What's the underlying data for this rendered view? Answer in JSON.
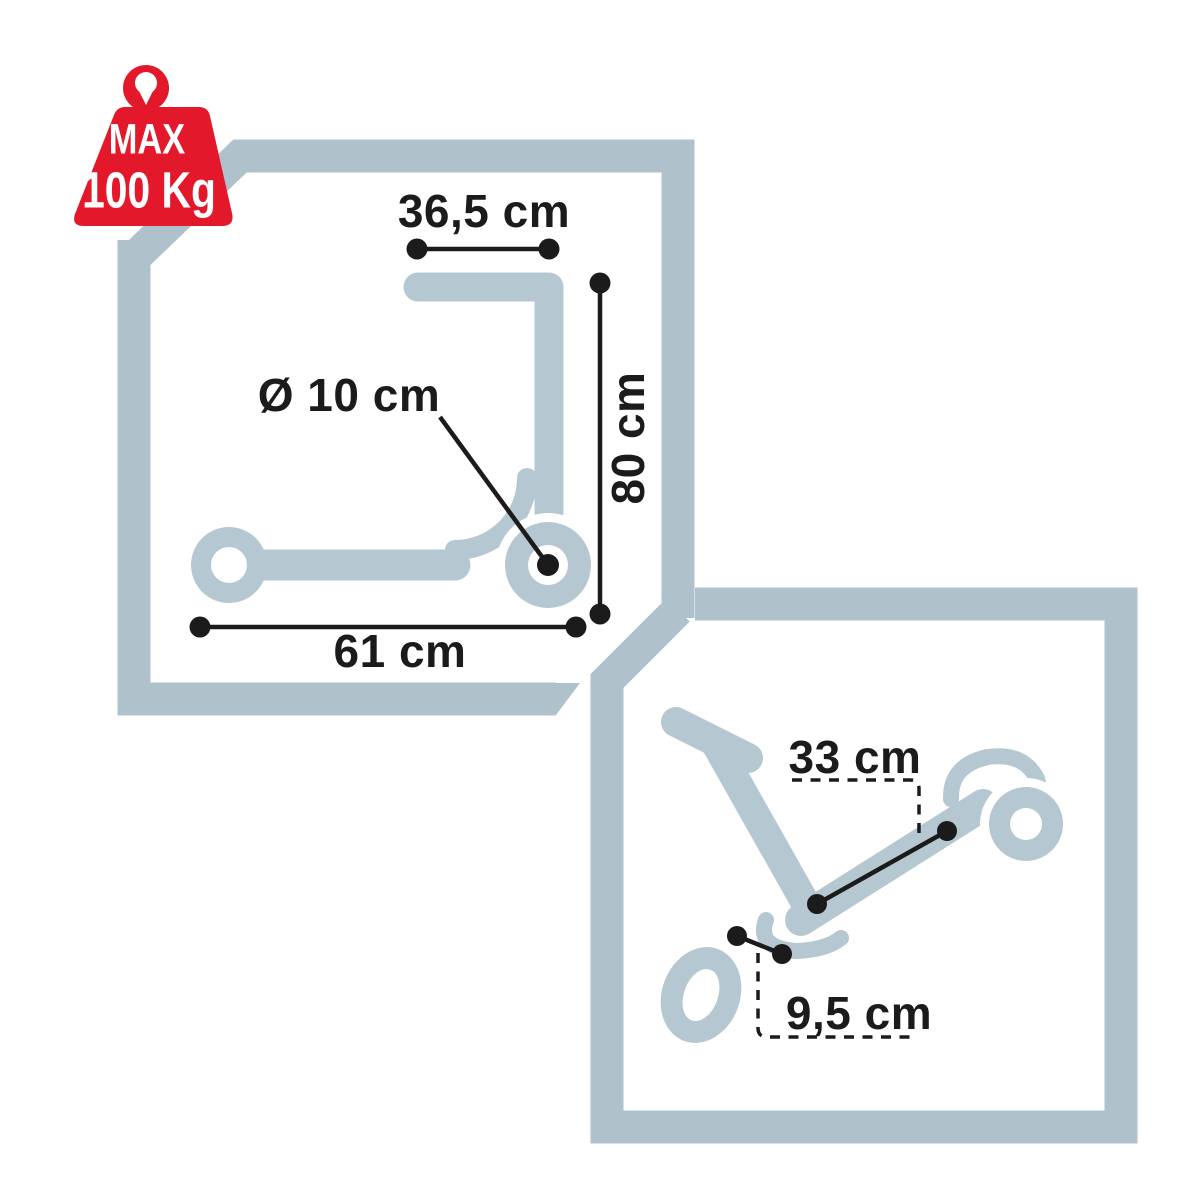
{
  "title": "Scooter dimensions diagram",
  "colors": {
    "background": "#ffffff",
    "frame": "#afc2cc",
    "silhouette": "#b5c8d2",
    "ink": "#1b1b1b",
    "badge_red": "#e4182b",
    "badge_text": "#ffffff"
  },
  "badge": {
    "icon": "max-weight-badge-icon",
    "line1": "MAX",
    "line2": "100 Kg"
  },
  "panels": {
    "unfolded": {
      "icon": "scooter-side-silhouette",
      "dimensions": {
        "handlebar_width": "36,5 cm",
        "height": "80 cm",
        "wheel_diameter": "Ø 10 cm",
        "length": "61 cm"
      }
    },
    "folded": {
      "icon": "scooter-folded-silhouette",
      "dimensions": {
        "folded_length": "33 cm",
        "folded_height": "9,5 cm"
      }
    }
  }
}
